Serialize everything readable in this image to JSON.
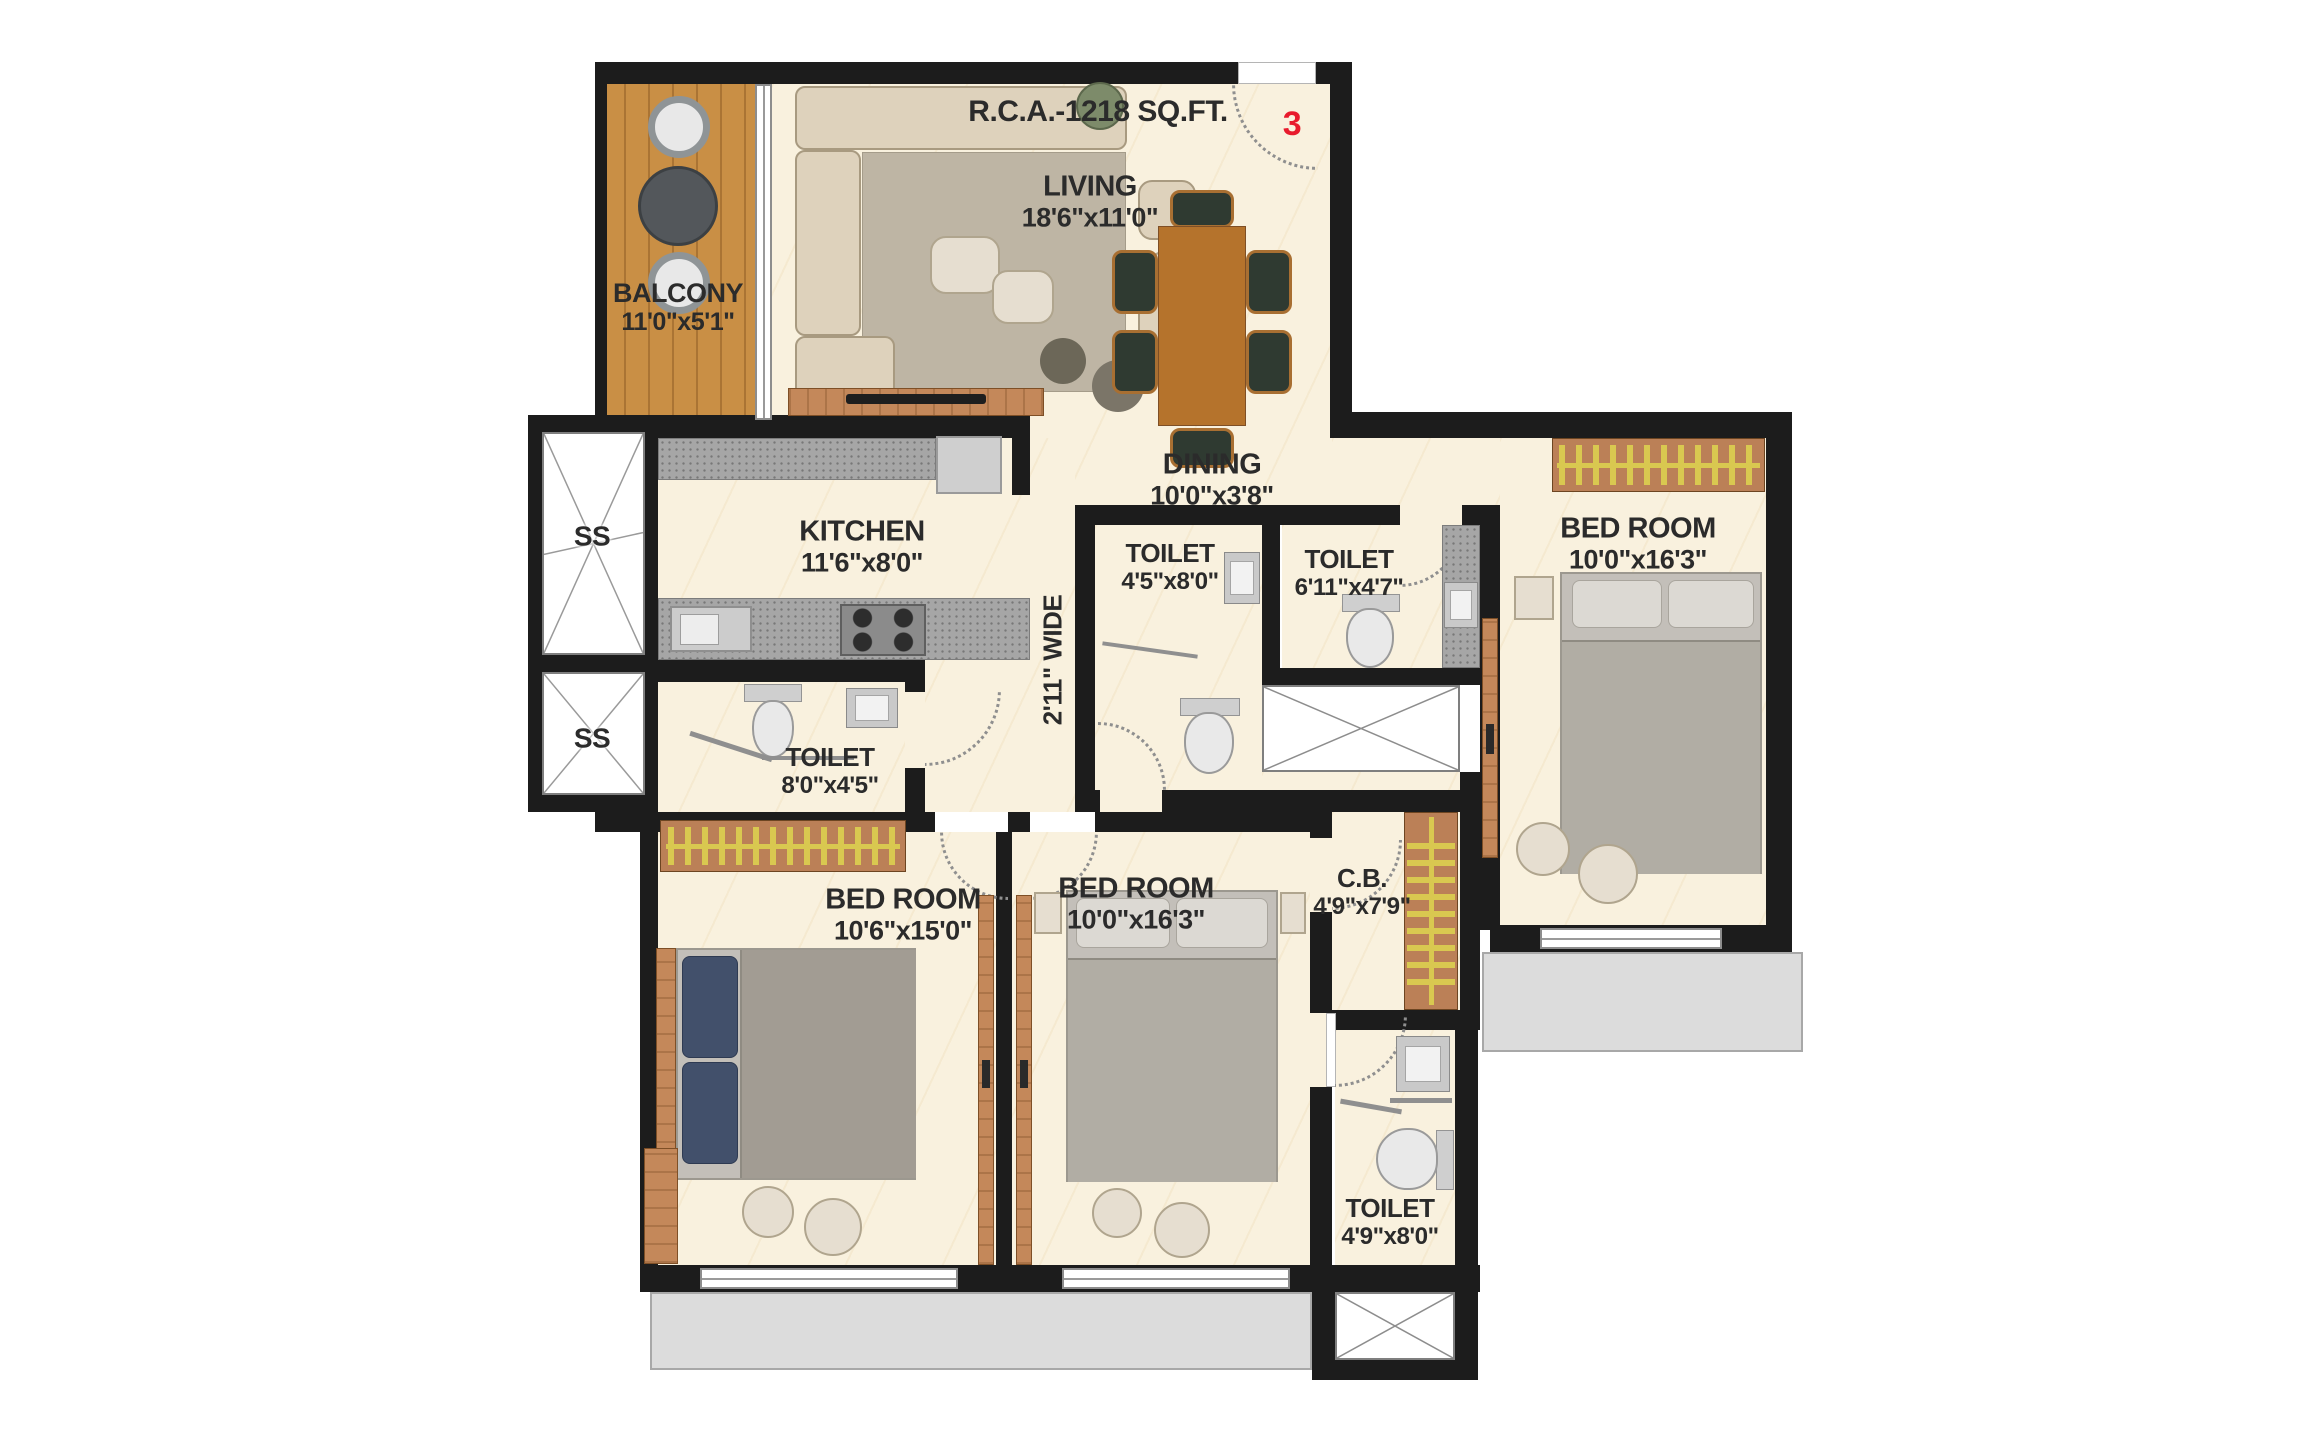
{
  "title": "R.C.A.-1218 SQ.FT.",
  "unit_number": "3",
  "rooms": {
    "living": {
      "name": "LIVING",
      "dims": "18'6\"x11'0\""
    },
    "balcony": {
      "name": "BALCONY",
      "dims": "11'0\"x5'1\""
    },
    "dining": {
      "name": "DINING",
      "dims": "10'0\"x3'8\""
    },
    "kitchen": {
      "name": "KITCHEN",
      "dims": "11'6\"x8'0\""
    },
    "toilet_center_left": {
      "name": "TOILET",
      "dims": "4'5\"x8'0\""
    },
    "toilet_center_right": {
      "name": "TOILET",
      "dims": "6'11\"x4'7\""
    },
    "bedroom_right": {
      "name": "BED ROOM",
      "dims": "10'0\"x16'3\""
    },
    "toilet_left": {
      "name": "TOILET",
      "dims": "8'0\"x4'5\""
    },
    "bedroom_bottom_left": {
      "name": "BED ROOM",
      "dims": "10'6\"x15'0\""
    },
    "bedroom_bottom_mid": {
      "name": "BED ROOM",
      "dims": "10'0\"x16'3\""
    },
    "cupboard": {
      "name": "C.B.",
      "dims": "4'9\"x7'9\""
    },
    "toilet_bottom": {
      "name": "TOILET",
      "dims": "4'9\"x8'0\""
    }
  },
  "passage": {
    "label": "2'11\" WIDE"
  },
  "shafts": {
    "top": "SS",
    "bottom": "SS"
  },
  "colors": {
    "wall": "#1c1c1c",
    "floor": "#f9f1de",
    "wood": "#c98f45",
    "accent_red": "#e81b2d",
    "ledge": "#dcdcdc"
  }
}
